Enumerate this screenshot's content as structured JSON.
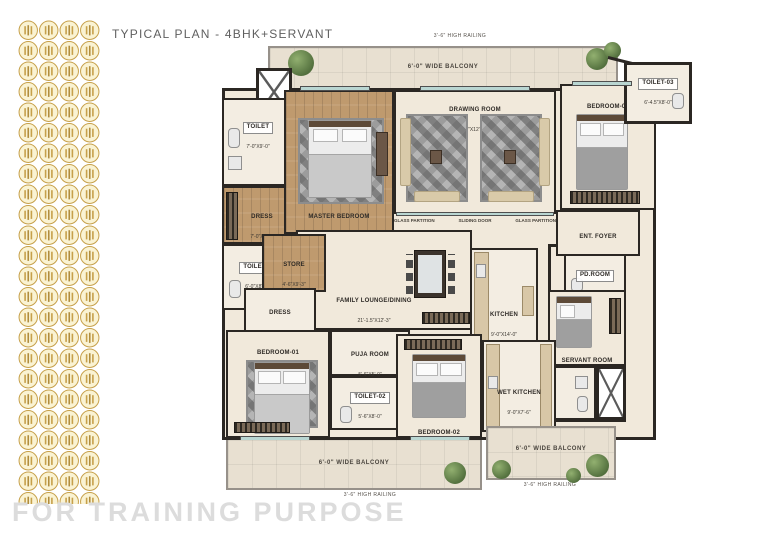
{
  "header": {
    "title": "TYPICAL PLAN - 4BHK+SERVANT"
  },
  "footer": {
    "watermark": "FOR TRAINING PURPOSE"
  },
  "plan": {
    "balconies": {
      "top": {
        "railing": "3'-6\" HIGH RAILING",
        "label": "6'-0\" WIDE BALCONY"
      },
      "bottom": {
        "railing": "3'-6\" HIGH RAILING",
        "label": "6'-0\" WIDE BALCONY"
      },
      "bottom_right": {
        "railing": "3'-6\" HIGH RAILING",
        "label": "6'-0\" WIDE BALCONY"
      }
    },
    "annotations": {
      "glass_partition_left": "GLASS PARTITION",
      "sliding_door": "SLIDING DOOR",
      "glass_partition_right": "GLASS PARTITION"
    },
    "rooms": {
      "toilet": {
        "name": "TOILET",
        "dims": "7'-0\"X9'-0\""
      },
      "master_bedroom": {
        "name": "MASTER BEDROOM",
        "dims": "12'-1.5\"X17'-0\""
      },
      "drawing_room": {
        "name": "DRAWING ROOM",
        "dims": "20'-0\"X12'-10.5\""
      },
      "bedroom_03": {
        "name": "BEDROOM-03",
        "dims": "11'-6\"X14'-0\""
      },
      "toilet_03": {
        "name": "TOILET-03",
        "dims": "6'-4.5\"X8'-0\""
      },
      "dress_1": {
        "name": "DRESS",
        "dims": "7'-0\"X6'-5\""
      },
      "toilet_01": {
        "name": "TOILET-01",
        "dims": "6'-0\"X8'-1.5\""
      },
      "store": {
        "name": "STORE",
        "dims": "4'-6\"X9'-3\""
      },
      "dress_2": {
        "name": "DRESS",
        "dims": "6'-3\"X6'-7.5\""
      },
      "ent_foyer": {
        "name": "ENT. FOYER",
        "dims": "7'-4.5\"X5'-0\""
      },
      "pd_room": {
        "name": "PD.ROOM",
        "dims": "5'-0\"X4'-6\""
      },
      "family_lounge": {
        "name": "FAMILY LOUNGE/DINING",
        "dims": "21'-1.5\"X12'-3\""
      },
      "kitchen": {
        "name": "KITCHEN",
        "dims": "9'-0\"X14'-0\""
      },
      "servant_room": {
        "name": "SERVANT ROOM",
        "dims": "6'-10.5\"X8'-0\""
      },
      "bedroom_01": {
        "name": "BEDROOM-01",
        "dims": "12'-0\"X15'-0\""
      },
      "puja_room": {
        "name": "PUJA ROOM",
        "dims": "5'-6\"X5'-0\""
      },
      "toilet_02": {
        "name": "TOILET-02",
        "dims": "5'-6\"X8'-0\""
      },
      "bedroom_02": {
        "name": "BEDROOM-02",
        "dims": "11'-6\"X15'-0\""
      },
      "wet_kitchen": {
        "name": "WET KITCHEN",
        "dims": "9'-0\"X7'-6\""
      }
    },
    "colors": {
      "brand_gold": "#c6a04a",
      "wall": "#2b2723",
      "floor": "#f1e9db",
      "wood_floor": "#bf9a6e",
      "balcony_tile": "#e8e0d1",
      "glass": "#b9d6d2",
      "watermark": "#dcdcdc",
      "title_text": "#5f5f5f"
    }
  }
}
